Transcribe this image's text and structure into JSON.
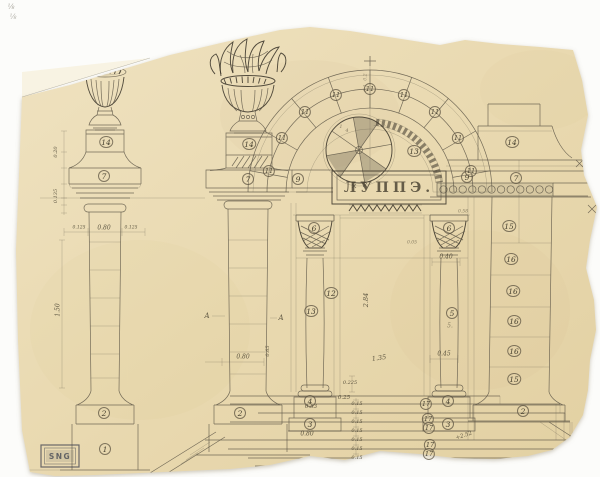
{
  "meta": {
    "frieze_text": "ЛУППЭ.",
    "stamp_text": "SNG"
  },
  "colors": {
    "paper": "#e9d9b0",
    "pencil": "#5e5748",
    "pencil_dark": "#3b352a",
    "background": "#fcfcfa",
    "stamp": "#3d4250"
  },
  "annotations": {
    "circled": [
      {
        "t": "14",
        "x": 106,
        "y": 142
      },
      {
        "t": "7",
        "x": 104,
        "y": 176
      },
      {
        "t": "2",
        "x": 104,
        "y": 413
      },
      {
        "t": "1",
        "x": 105,
        "y": 449
      },
      {
        "t": "14",
        "x": 249,
        "y": 144
      },
      {
        "t": "7",
        "x": 248,
        "y": 179
      },
      {
        "t": "2",
        "x": 240,
        "y": 413
      },
      {
        "t": "9",
        "x": 298,
        "y": 179
      },
      {
        "t": "9",
        "x": 467,
        "y": 177
      },
      {
        "t": "7",
        "x": 516,
        "y": 178
      },
      {
        "t": "14",
        "x": 512,
        "y": 142
      },
      {
        "t": "11",
        "x": 269,
        "y": 171,
        "fs": 6.5
      },
      {
        "t": "11",
        "x": 282,
        "y": 138,
        "fs": 6.5
      },
      {
        "t": "11",
        "x": 305,
        "y": 112,
        "fs": 6.5
      },
      {
        "t": "11",
        "x": 336,
        "y": 95,
        "fs": 6.5
      },
      {
        "t": "11",
        "x": 370,
        "y": 89,
        "fs": 6.5
      },
      {
        "t": "11",
        "x": 404,
        "y": 95,
        "fs": 6.5
      },
      {
        "t": "11",
        "x": 435,
        "y": 112,
        "fs": 6.5
      },
      {
        "t": "11",
        "x": 458,
        "y": 138,
        "fs": 6.5
      },
      {
        "t": "11",
        "x": 471,
        "y": 171,
        "fs": 6.5
      },
      {
        "t": "13",
        "x": 414,
        "y": 151
      },
      {
        "t": "6",
        "x": 314,
        "y": 228
      },
      {
        "t": "6",
        "x": 449,
        "y": 228
      },
      {
        "t": "12",
        "x": 331,
        "y": 293
      },
      {
        "t": "13",
        "x": 311,
        "y": 311
      },
      {
        "t": "5",
        "x": 452,
        "y": 313
      },
      {
        "t": "4",
        "x": 310,
        "y": 401
      },
      {
        "t": "3",
        "x": 310,
        "y": 424
      },
      {
        "t": "4",
        "x": 448,
        "y": 401
      },
      {
        "t": "3",
        "x": 448,
        "y": 424
      },
      {
        "t": "15",
        "x": 509,
        "y": 226
      },
      {
        "t": "16",
        "x": 511,
        "y": 259
      },
      {
        "t": "16",
        "x": 513,
        "y": 291
      },
      {
        "t": "16",
        "x": 514,
        "y": 321
      },
      {
        "t": "16",
        "x": 514,
        "y": 351
      },
      {
        "t": "15",
        "x": 514,
        "y": 379
      },
      {
        "t": "2",
        "x": 523,
        "y": 411
      },
      {
        "t": "17",
        "x": 426,
        "y": 404,
        "fs": 6.5
      },
      {
        "t": "17",
        "x": 428,
        "y": 419,
        "fs": 6.5
      },
      {
        "t": "17",
        "x": 429,
        "y": 428,
        "fs": 6.5
      },
      {
        "t": "17",
        "x": 430,
        "y": 445,
        "fs": 6.5
      },
      {
        "t": "17",
        "x": 429,
        "y": 454,
        "fs": 6.5
      }
    ],
    "plain": [
      {
        "t": "0.80",
        "x": 104,
        "y": 228,
        "fs": 6
      },
      {
        "t": "0.125",
        "x": 79,
        "y": 228,
        "fs": 4.5
      },
      {
        "t": "0.125",
        "x": 131,
        "y": 228,
        "fs": 4.5
      },
      {
        "t": "0.20",
        "x": 56,
        "y": 152,
        "fs": 5,
        "rot": -90
      },
      {
        "t": "0.135",
        "x": 56,
        "y": 196,
        "fs": 5,
        "rot": -90
      },
      {
        "t": "1.50",
        "x": 58,
        "y": 310,
        "fs": 6,
        "rot": -90
      },
      {
        "t": "0.80",
        "x": 243,
        "y": 357,
        "fs": 6
      },
      {
        "t": "0.65",
        "x": 268,
        "y": 351,
        "fs": 5,
        "rot": -90
      },
      {
        "t": "A",
        "x": 207,
        "y": 316,
        "fs": 7
      },
      {
        "t": "A",
        "x": 281,
        "y": 318,
        "fs": 7
      },
      {
        "t": "0.2",
        "x": 366,
        "y": 77,
        "fs": 4.5,
        "rot": -90,
        "op": 0.5
      },
      {
        "t": "0.1",
        "x": 366,
        "y": 88,
        "fs": 4.5,
        "rot": -90,
        "op": 0.5
      },
      {
        "t": "1",
        "x": 341,
        "y": 127,
        "fs": 5,
        "op": 0.6
      },
      {
        "t": "4",
        "x": 347,
        "y": 131,
        "fs": 5,
        "op": 0.6
      },
      {
        "t": "0.05",
        "x": 412,
        "y": 243,
        "fs": 4.5,
        "op": 0.6
      },
      {
        "t": "0.58",
        "x": 463,
        "y": 212,
        "fs": 4.5,
        "op": 0.6
      },
      {
        "t": "0.40",
        "x": 446,
        "y": 257,
        "fs": 6
      },
      {
        "t": "0.45",
        "x": 444,
        "y": 354,
        "fs": 6
      },
      {
        "t": "2.84",
        "x": 366,
        "y": 300,
        "fs": 6.5,
        "rot": -90
      },
      {
        "t": "1.35",
        "x": 379,
        "y": 358,
        "fs": 6.5,
        "rot": -8
      },
      {
        "t": "0.225",
        "x": 350,
        "y": 383,
        "fs": 5
      },
      {
        "t": "0.25",
        "x": 344,
        "y": 398,
        "fs": 5.5
      },
      {
        "t": "0.15",
        "x": 357,
        "y": 404,
        "fs": 5
      },
      {
        "t": "0.15",
        "x": 357,
        "y": 413,
        "fs": 5
      },
      {
        "t": "0.15",
        "x": 357,
        "y": 422,
        "fs": 5
      },
      {
        "t": "0.15",
        "x": 357,
        "y": 431,
        "fs": 5
      },
      {
        "t": "0.15",
        "x": 357,
        "y": 440,
        "fs": 5
      },
      {
        "t": "0.15",
        "x": 357,
        "y": 449,
        "fs": 5
      },
      {
        "t": "0.15",
        "x": 357,
        "y": 458,
        "fs": 5
      },
      {
        "t": "0.53",
        "x": 311,
        "y": 407,
        "fs": 5.5
      },
      {
        "t": "0.80",
        "x": 307,
        "y": 434,
        "fs": 6
      },
      {
        "t": "5.",
        "x": 450,
        "y": 326,
        "fs": 6,
        "op": 0.6
      },
      {
        "t": "+2.52",
        "x": 464,
        "y": 436,
        "fs": 5.5,
        "rot": -18
      },
      {
        "t": "⅛",
        "x": 11,
        "y": 7,
        "fs": 7,
        "op": 0.5
      },
      {
        "t": "⅛",
        "x": 13,
        "y": 17,
        "fs": 7,
        "op": 0.45
      }
    ]
  }
}
